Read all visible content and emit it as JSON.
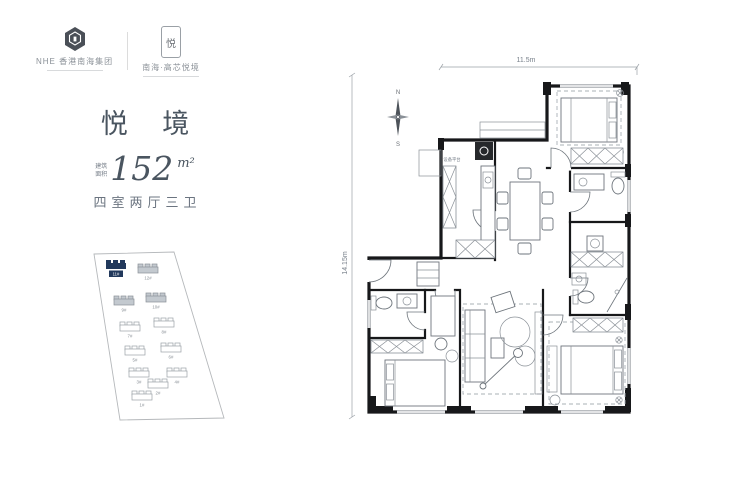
{
  "brand": {
    "group": {
      "name": "NHE 香港南海集团"
    },
    "project": {
      "name": "南海·高芯悦境",
      "seal_char": "悦"
    }
  },
  "unit": {
    "title": "悦 境",
    "area_label_top": "建筑",
    "area_label_bottom": "面积",
    "area_value": "152",
    "area_unit": "m²",
    "rooms_desc": "四室两厅三卫"
  },
  "floorplan": {
    "dim_width": "11.5m",
    "dim_height": "14.15m",
    "compass": {
      "north": "N",
      "south": "S"
    },
    "labels": {
      "equipment_platform": "设备平台"
    }
  },
  "siteplan": {
    "highlighted_building": "11#",
    "buildings": [
      {
        "label": "11#",
        "highlighted": true
      },
      {
        "label": "12#",
        "shaded": true
      },
      {
        "label": "9#",
        "shaded": true
      },
      {
        "label": "10#",
        "shaded": true
      },
      {
        "label": "7#"
      },
      {
        "label": "8#"
      },
      {
        "label": "5#"
      },
      {
        "label": "6#"
      },
      {
        "label": "3#"
      },
      {
        "label": "4#"
      },
      {
        "label": "2#"
      },
      {
        "label": "1#"
      }
    ]
  },
  "colors": {
    "accent_navy": "#22395c",
    "wall": "#17181a",
    "line_gray": "#9aa0a6"
  }
}
